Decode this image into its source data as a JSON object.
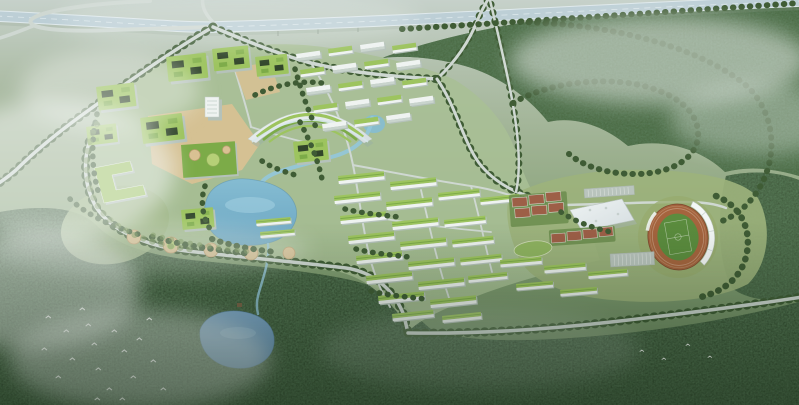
{
  "meta": {
    "title": "Aerial bird's-eye rendering of a green university campus masterplan beside a highway interchange, wrapped by forest and drifting mist",
    "medium": "photorealistic architectural visualization",
    "time_of_day": "hazy daylight"
  },
  "palette": {
    "haze_top": "#c6d1ca",
    "haze_mid": "#b0bfaa",
    "field_green": "#9cb08f",
    "field_mid": "#84a075",
    "field_low": "#66845c",
    "campus_ground": "#a9bf95",
    "sports_ground": "#9cb27c",
    "forest_mid": "#4a6741",
    "forest_strip": "#41593a",
    "forest_dark": "#33492f",
    "tree_green": "#3f5c35",
    "tree_bright": "#6d8c4b",
    "road_grey": "#cfd8d2",
    "road_edge": "#e8eee9",
    "highway_deck": "#bdcfd6",
    "highway_edge": "#dfe9ec",
    "roof_green": "#9dc45f",
    "roof_green_dark": "#7cab48",
    "facade_white": "#eff3f1",
    "facade_shade": "#b5c2ba",
    "facade_front": "#c9d4cd",
    "courtyard_dark": "#31452a",
    "plaza_tan": "#d9c193",
    "plaza_ring": "#bfa071",
    "lake_blue": "#85bcd2",
    "lake_deep": "#6ba6c2",
    "pond_blue": "#7fa9cc",
    "pond_deep": "#5e8cb4",
    "stream_blue": "#93c6da",
    "track_clay": "#a5643e",
    "pitch_green": "#5b8c3e",
    "court_clay": "#9d5f47",
    "gym_roof": "#eef3f3",
    "gym_shade": "#d5dde0",
    "lawn_green": "#8fb360",
    "parking_grey": "#b9c4bd",
    "mist_white": "#f4f8f6",
    "bird_white": "#fafcfa",
    "vignette": "#142614"
  },
  "scene": {
    "transport": {
      "elevated_highway": "Elevated expressway crossing the top of the site",
      "interchange": "Looped ramp interchange at the top left",
      "approach_avenue": "Tree-lined avenue running from the interchange along the north-west edge",
      "campus_loop_road": "Tree-lined loop road enclosing the campus",
      "south_boundary_road": "Tree-lined road along the southern edge",
      "forest_roads": "Winding tree-lined roads through the eastern woodland"
    },
    "campus": {
      "library_arc": "Large crescent building with stepped green roof and glass south face",
      "academic_courtyards": "Green-roofed courtyard teaching blocks on the west cluster",
      "podium_block": "Flat green podium roof with circular gardens",
      "serpentine_block": "S-shaped green-roofed block on the western rim",
      "tower": "White mid-rise tower",
      "dormitory_slabs": "Grid of white dormitory slabs at the north-east",
      "terraced_rows": "Parallel rows of green-roofed terraced housing to the south-east",
      "plazas": "Tan paved plazas and round garden courts",
      "central_lake": "Turquoise lake at the heart of the campus",
      "outlet_stream": "Stream running south from the lake to the forest pond"
    },
    "sports": {
      "stadium": "Oval stadium with clay running track, green pitch and white segmented grandstand canopy",
      "gymnasium": "White flat-roofed sports hall",
      "tennis_courts": "Clay-coloured court groups beside the gymnasium",
      "practice_lawn": "Oval practice lawn",
      "parking": "Striped parking lots beside the stadium"
    },
    "nature": {
      "forest": "Dense dark woodland wrapping the east and south of the site",
      "forest_pond": "Blue pond in the south-west woodland with a small pavilion",
      "mist": "White mist banks drifting over the left side and upper right",
      "birds": "Flocks of small white birds over the south-west forest"
    }
  }
}
